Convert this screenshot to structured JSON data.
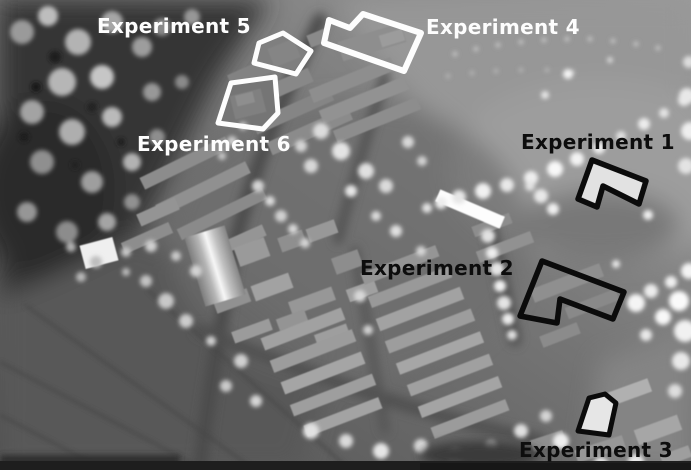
{
  "figure": {
    "type": "lidar-dsm-aerial-image",
    "description": "Greyscale airborne LiDAR digital surface model of a residential district with six outlined experiment regions"
  },
  "annotations": {
    "experiments": [
      {
        "id": "experiment-1",
        "label": "Experiment 1",
        "label_color": "#0d0d0d",
        "outline_color": "#0b0b0b",
        "outline_width": "5.5",
        "points": "592,160 646,181 639,204 603,186 597,207 578,199"
      },
      {
        "id": "experiment-2",
        "label": "Experiment 2",
        "label_color": "#0d0d0d",
        "outline_color": "#0b0b0b",
        "outline_width": "5.5",
        "points": "542,261 624,292 613,319 560,299 557,323 520,316"
      },
      {
        "id": "experiment-3",
        "label": "Experiment 3",
        "label_color": "#0d0d0d",
        "outline_color": "#0b0b0b",
        "outline_width": "5",
        "points": "589,398 605,394 616,403 609,435 578,431"
      },
      {
        "id": "experiment-4",
        "label": "Experiment 4",
        "label_color": "#fdfdfd",
        "outline_color": "#fdfdfd",
        "outline_width": "6",
        "points": "329,20 350,28 363,14 421,33 404,71 324,43"
      },
      {
        "id": "experiment-5",
        "label": "Experiment 5",
        "label_color": "#fdfdfd",
        "outline_color": "#fdfdfd",
        "outline_width": "5",
        "points": "259,43 283,33 311,51 296,74 254,63"
      },
      {
        "id": "experiment-6",
        "label": "Experiment 6",
        "label_color": "#fdfdfd",
        "outline_color": "#fdfdfd",
        "outline_width": "5",
        "points": "231,83 275,77 278,113 263,129 218,123"
      }
    ]
  }
}
